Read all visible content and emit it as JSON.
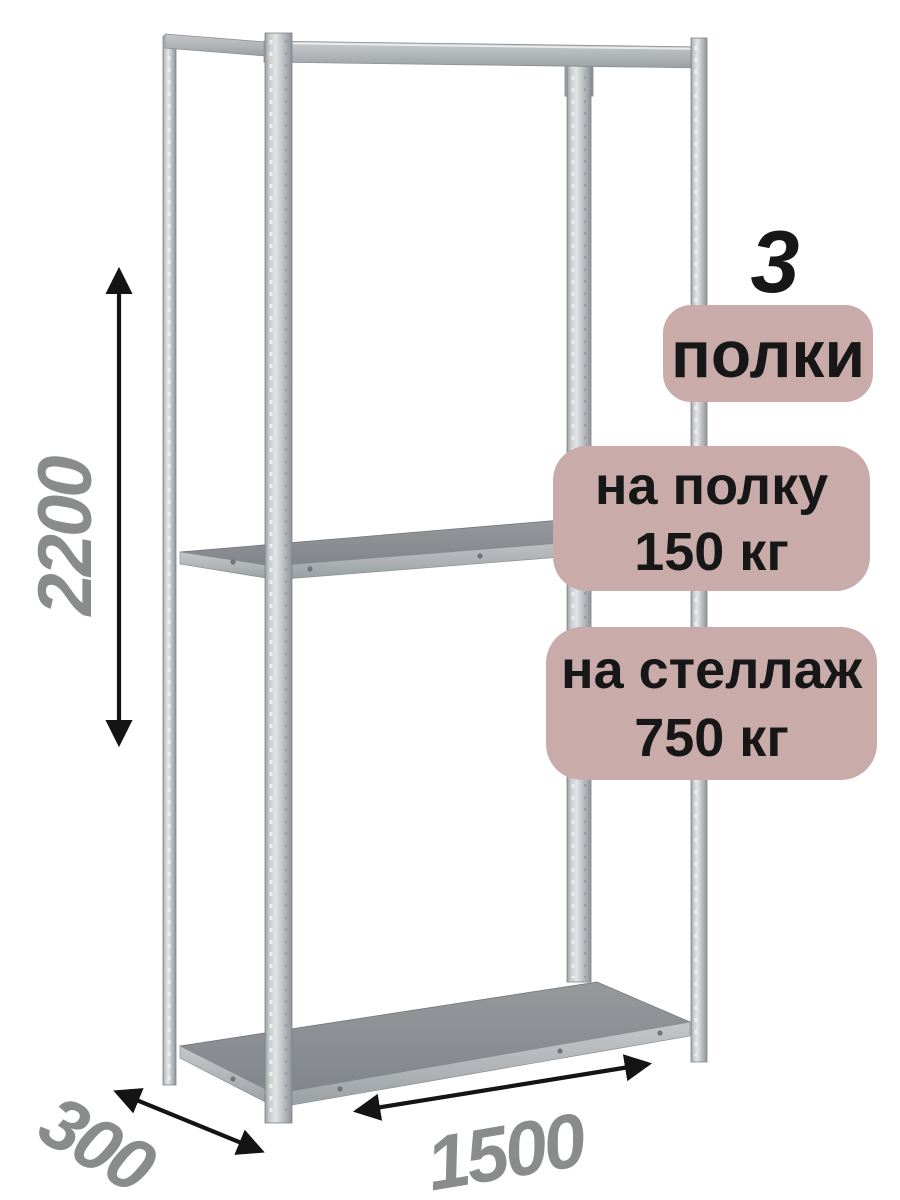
{
  "canvas": {
    "width": 900,
    "height": 1200,
    "background": "#ffffff"
  },
  "badges": {
    "count": {
      "number": "3",
      "label": "полки"
    },
    "per_shelf": {
      "line1": "на полку",
      "line2": "150 кг"
    },
    "per_rack": {
      "line1": "на стеллаж",
      "line2": "750 кг"
    },
    "fill_color": "#c9acaa",
    "text_color": "#171717"
  },
  "dimensions": {
    "height_mm": "2200",
    "depth_mm": "300",
    "width_mm": "1500",
    "label_color": "#8a8c8c",
    "arrow_color": "#141414"
  },
  "rack": {
    "type": "metal-shelving-unit",
    "shelf_count": 3,
    "post_count": 4,
    "metal_highlight": "#e2e4e5",
    "metal_base": "#b9bdc0",
    "metal_shadow": "#8f9498",
    "shelf_surface_color": "#8a8e92"
  },
  "icons": {
    "height_arrow": "double-headed-vertical-arrow",
    "depth_arrow": "double-headed-diagonal-arrow",
    "width_arrow": "double-headed-diagonal-arrow"
  }
}
